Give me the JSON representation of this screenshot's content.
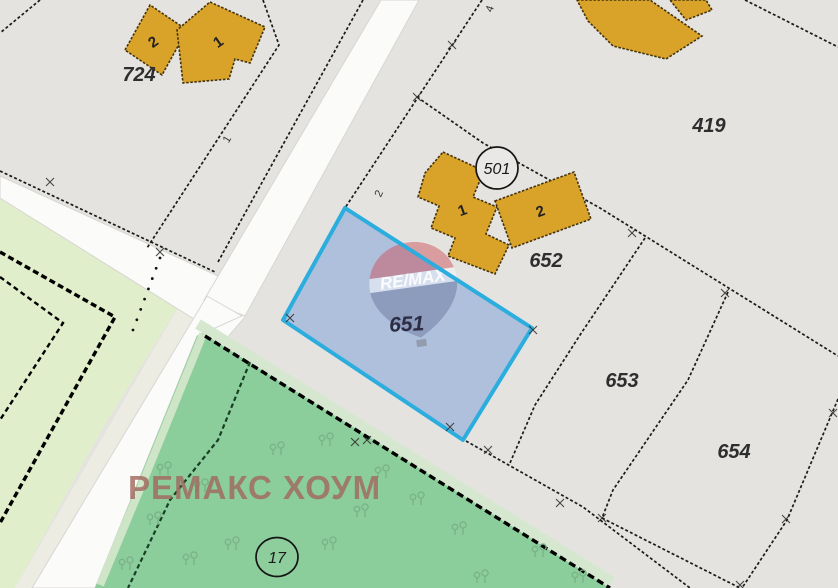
{
  "map": {
    "bg_color": "#e4e3e0",
    "watermark": {
      "brand_text": "РЕМАКС ХОУМ",
      "brand_color": "rgba(161,104,94,0.82)",
      "logo_text": "RE/MAX",
      "cx": 414,
      "cy": 289,
      "rot": -8,
      "red": "rgba(205,80,88,0.48)",
      "white": "rgba(248,248,252,0.55)",
      "blue": "rgba(108,118,158,0.50)",
      "text_color": "rgba(255,255,255,0.88)"
    },
    "selected_parcel": {
      "id": "651",
      "points": "345,208 532,328 463,440 283,320",
      "fill": "rgba(127,160,218,0.52)",
      "border": "#2badde",
      "border_width": 4,
      "label": "651",
      "lx": 407,
      "ly": 331,
      "label_color": "#2c2c44"
    },
    "polygons": [
      {
        "name": "pale-green-area",
        "points": "0,198 190,287 100,433 15,588 0,588",
        "fill": "#e1eecb"
      },
      {
        "name": "roadside-strip",
        "points": "190,287 207,296 32,588 15,588",
        "fill": "#edece3"
      },
      {
        "name": "road-secondary",
        "points": "0,176 218,276 245,317 226,339 0,198",
        "fill": "#fbfbf9",
        "stroke": "#d7d6d3"
      },
      {
        "name": "road-main-upper",
        "points": "381,0 419,0 245,316 204,300",
        "fill": "#fbfbf9",
        "stroke": "#d7d6d3"
      },
      {
        "name": "road-main-lower",
        "points": "207,296 242,316 197,336 140,477 95,588 32,588",
        "fill": "#fbfbf9",
        "stroke": "#d7d6d3"
      },
      {
        "name": "green-area",
        "points": "203,332 610,588 95,588 140,477 197,336",
        "fill": "#8ccd9c"
      }
    ],
    "lines": [
      {
        "name": "green-fringe-top",
        "points": "198,324 612,582",
        "color": "#d5e8cf",
        "width": 11
      },
      {
        "name": "green-fringe-road",
        "points": "203,334 145,477 100,585",
        "color": "#cfe5c8",
        "width": 8
      },
      {
        "name": "green-boundary",
        "points": "205,336 610,588",
        "color": "#000000",
        "width": 3.4,
        "dash": "7 4"
      },
      {
        "name": "green-inner-path",
        "points": "250,362 218,440 170,500 128,588",
        "color": "#173f22",
        "width": 2.2,
        "dash": "4.5 3"
      },
      {
        "name": "pale-parcel-outer",
        "points": "0,252 115,317 0,523",
        "color": "#000000",
        "width": 3.4,
        "dash": "6 3.5"
      },
      {
        "name": "pale-parcel-inner",
        "points": "0,277 63,323 0,420",
        "color": "#000000",
        "width": 2.4,
        "dash": "5 3.5"
      },
      {
        "name": "boundary-corner-nw",
        "points": "40,0 0,33",
        "color": "#1b1b1b",
        "width": 1.7,
        "dash": "3 2.2"
      },
      {
        "name": "boundary-724-east",
        "points": "263,0 279,45 147,248",
        "color": "#1b1b1b",
        "width": 1.7,
        "dash": "3 2.2"
      },
      {
        "name": "boundary-along-road-west",
        "points": "363,0 218,262",
        "color": "#1b1b1b",
        "width": 1.7,
        "dash": "3 2.2"
      },
      {
        "name": "boundary-road-secondary-north",
        "points": "0,171 215,272",
        "color": "#1b1b1b",
        "width": 1.7,
        "dash": "3 2.2"
      },
      {
        "name": "boundary-north-of-651",
        "points": "482,0 345,208",
        "color": "#1b1b1b",
        "width": 1.7,
        "dash": "3 2.2"
      },
      {
        "name": "boundary-419-south",
        "points": "417,97 483,143 600,208 838,356",
        "color": "#1b1b1b",
        "width": 1.7,
        "dash": "3 2.2"
      },
      {
        "name": "boundary-419-northeast",
        "points": "745,0 838,47",
        "color": "#1b1b1b",
        "width": 1.7,
        "dash": "3 2.2"
      },
      {
        "name": "boundary-652-east",
        "points": "645,238 580,335 535,405 510,463",
        "color": "#1b1b1b",
        "width": 1.7,
        "dash": "3 2.2"
      },
      {
        "name": "boundary-653-south",
        "points": "466,441 583,507 690,588",
        "color": "#1b1b1b",
        "width": 1.7,
        "dash": "3 2.2"
      },
      {
        "name": "boundary-653-654",
        "points": "728,292 688,380 613,490 602,518 740,588",
        "color": "#1b1b1b",
        "width": 1.7,
        "dash": "3 2.2"
      },
      {
        "name": "boundary-654-east",
        "points": "838,399 787,520 742,588",
        "color": "#1b1b1b",
        "width": 1.7,
        "dash": "3 2.2"
      }
    ],
    "buildings": [
      {
        "name": "building-724-2",
        "points": "125,50 150,5 187,30 162,75",
        "label": "2",
        "lx": 156,
        "ly": 46,
        "rot": -35
      },
      {
        "name": "building-724-1",
        "points": "210,2 265,27 250,63 235,59 229,79 183,83 177,30",
        "label": "1",
        "lx": 221,
        "ly": 46,
        "rot": -35
      },
      {
        "name": "building-ne-large",
        "points": "577,0 650,0 702,36 666,59 613,46 588,21",
        "label": "",
        "lx": 0,
        "ly": 0,
        "rot": 0
      },
      {
        "name": "building-ne-small",
        "points": "670,0 706,0 712,10 686,20",
        "label": "",
        "lx": 0,
        "ly": 0,
        "rot": 0
      },
      {
        "name": "building-652-1",
        "points": "443,152 484,171 473,197 497,207 486,234 509,245 495,274 448,256 455,238 431,228 439,206 418,197 425,173",
        "label": "1",
        "lx": 464,
        "ly": 215,
        "rot": -20
      },
      {
        "name": "building-652-2",
        "points": "495,201 574,172 591,219 512,248",
        "label": "2",
        "lx": 542,
        "ly": 216,
        "rot": -20
      }
    ],
    "building_style": {
      "fill": "#d9a228",
      "stroke": "#43320c"
    },
    "circle_labels": [
      {
        "name": "point-501",
        "text": "501",
        "cx": 497,
        "cy": 168,
        "rx": 21,
        "ry": 21,
        "fill": "#e9e8e6"
      },
      {
        "name": "point-17",
        "text": "17",
        "cx": 277,
        "cy": 557,
        "rx": 21,
        "ry": 19.5,
        "fill": "#8ecd9c"
      }
    ],
    "parcel_labels": [
      {
        "text": "724",
        "x": 139,
        "y": 81
      },
      {
        "text": "419",
        "x": 709,
        "y": 132
      },
      {
        "text": "652",
        "x": 546,
        "y": 267
      },
      {
        "text": "653",
        "x": 622,
        "y": 387
      },
      {
        "text": "654",
        "x": 734,
        "y": 458
      }
    ],
    "small_labels": [
      {
        "text": "4",
        "x": 493,
        "y": 10,
        "rot": -70
      },
      {
        "text": "2",
        "x": 382,
        "y": 195,
        "rot": -65
      },
      {
        "text": "1",
        "x": 230,
        "y": 141,
        "rot": -60
      }
    ],
    "crosses": [
      [
        417,
        97
      ],
      [
        452,
        45
      ],
      [
        160,
        252
      ],
      [
        50,
        182
      ],
      [
        632,
        233
      ],
      [
        725,
        293
      ],
      [
        488,
        450
      ],
      [
        560,
        503
      ],
      [
        602,
        518
      ],
      [
        833,
        413
      ],
      [
        786,
        519
      ],
      [
        290,
        318
      ],
      [
        355,
        442
      ],
      [
        533,
        330
      ],
      [
        367,
        440
      ],
      [
        740,
        585
      ],
      [
        450,
        427
      ]
    ],
    "dots": {
      "x1": 160,
      "y1": 258,
      "x2": 133,
      "y2": 330,
      "count": 8
    },
    "trees": [
      [
        160,
        470
      ],
      [
        273,
        450
      ],
      [
        322,
        441
      ],
      [
        378,
        473
      ],
      [
        150,
        520
      ],
      [
        186,
        560
      ],
      [
        228,
        545
      ],
      [
        325,
        545
      ],
      [
        413,
        500
      ],
      [
        357,
        512
      ],
      [
        455,
        530
      ],
      [
        535,
        552
      ],
      [
        477,
        578
      ],
      [
        197,
        487
      ],
      [
        122,
        565
      ],
      [
        575,
        578
      ]
    ],
    "tree_color": "#7ab287"
  }
}
